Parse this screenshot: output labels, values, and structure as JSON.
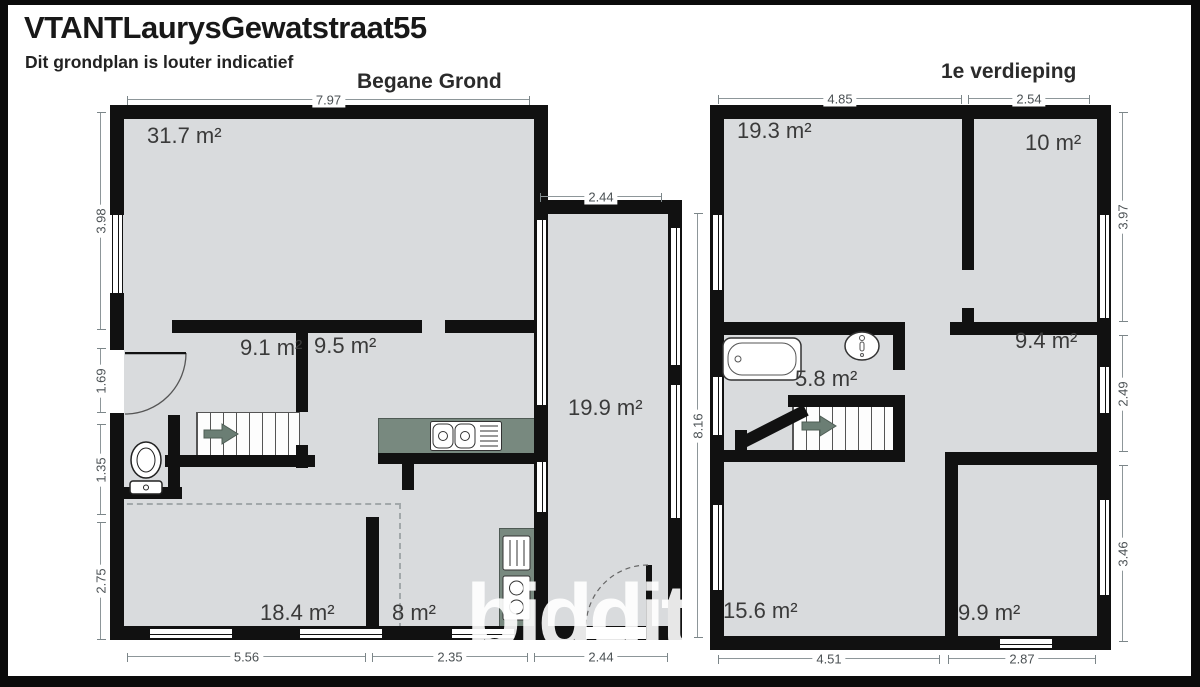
{
  "header": {
    "title": "VTANTLaurysGewatstraat55",
    "subtitle": "Dit grondplan is louter indicatief"
  },
  "watermark": "biddit",
  "colors": {
    "wall": "#111111",
    "floor_fill": "#d9dbdd",
    "kitchen_counter": "#78897f",
    "stair_arrow": "#6b7e74",
    "dimension_text": "#4b5154"
  },
  "floors": [
    {
      "name": "Begane Grond",
      "rooms": [
        {
          "label": "31.7 m²"
        },
        {
          "label": "9.1 m²"
        },
        {
          "label": "9.5 m²"
        },
        {
          "label": "19.9 m²"
        },
        {
          "label": "18.4 m²"
        },
        {
          "label": "8 m²"
        }
      ],
      "fixtures": [
        "staircase",
        "toilet",
        "kitchen-sink",
        "stove-oven",
        "entry-door",
        "rear-door"
      ],
      "dims": {
        "top": "7.97",
        "top_ext": "2.44",
        "left": [
          "3.98",
          "1.69",
          "1.35",
          "2.75"
        ],
        "right": "8.16",
        "bottom": [
          "5.56",
          "2.35",
          "2.44"
        ]
      }
    },
    {
      "name": "1e verdieping",
      "rooms": [
        {
          "label": "19.3 m²"
        },
        {
          "label": "10 m²"
        },
        {
          "label": "9.4 m²"
        },
        {
          "label": "5.8 m²"
        },
        {
          "label": "15.6 m²"
        },
        {
          "label": "9.9 m²"
        }
      ],
      "fixtures": [
        "staircase",
        "bathtub",
        "washbasin"
      ],
      "dims": {
        "top": [
          "4.85",
          "2.54"
        ],
        "right": [
          "3.97",
          "2.49",
          "3.46"
        ],
        "bottom": [
          "4.51",
          "2.87"
        ]
      }
    }
  ]
}
